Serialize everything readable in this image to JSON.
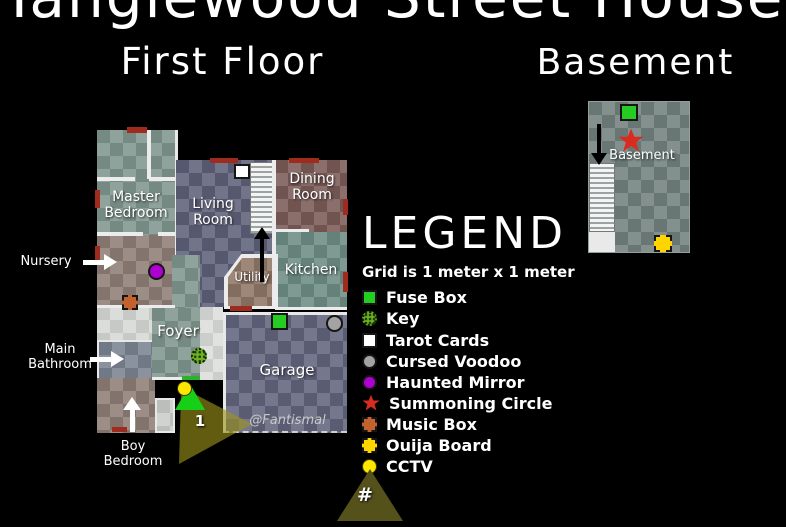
{
  "title": "Tanglewood Street House",
  "headings": {
    "first_floor": "First Floor",
    "basement": "Basement"
  },
  "credit": "@Fantismal",
  "rooms": {
    "master_bedroom": "Master Bedroom",
    "living_room": "Living Room",
    "dining_room": "Dining Room",
    "kitchen": "Kitchen",
    "utility": "Utility",
    "foyer": "Foyer",
    "garage": "Garage",
    "nursery": "Nursery",
    "main_bathroom": "Main Bathroom",
    "boy_bedroom": "Boy Bedroom",
    "basement": "Basement"
  },
  "legend": {
    "heading": "LEGEND",
    "grid_note": "Grid is 1 meter x 1 meter",
    "items": [
      {
        "name": "fuse-box",
        "label": "Fuse Box",
        "shape": "square",
        "color": "#25cc21"
      },
      {
        "name": "key",
        "label": "Key",
        "shape": "dotted-circle",
        "color": "#6fae25"
      },
      {
        "name": "tarot-cards",
        "label": "Tarot Cards",
        "shape": "square",
        "color": "#ffffff"
      },
      {
        "name": "cursed-voodoo",
        "label": "Cursed Voodoo",
        "shape": "circle",
        "color": "#a3a3a3"
      },
      {
        "name": "haunted-mirror",
        "label": "Haunted Mirror",
        "shape": "circle",
        "color": "#ae00d0"
      },
      {
        "name": "summoning-circle",
        "label": "Summoning Circle",
        "shape": "star",
        "color": "#d92c21"
      },
      {
        "name": "music-box",
        "label": "Music Box",
        "shape": "square-dashed",
        "color": "#c2622e"
      },
      {
        "name": "ouija-board",
        "label": "Ouija Board",
        "shape": "square-dashed",
        "color": "#ffd500"
      },
      {
        "name": "cctv",
        "label": "CCTV",
        "shape": "circle",
        "color": "#ffe600"
      }
    ],
    "camera_cone_symbol": "#"
  },
  "cameras": {
    "camera_1": "1"
  }
}
